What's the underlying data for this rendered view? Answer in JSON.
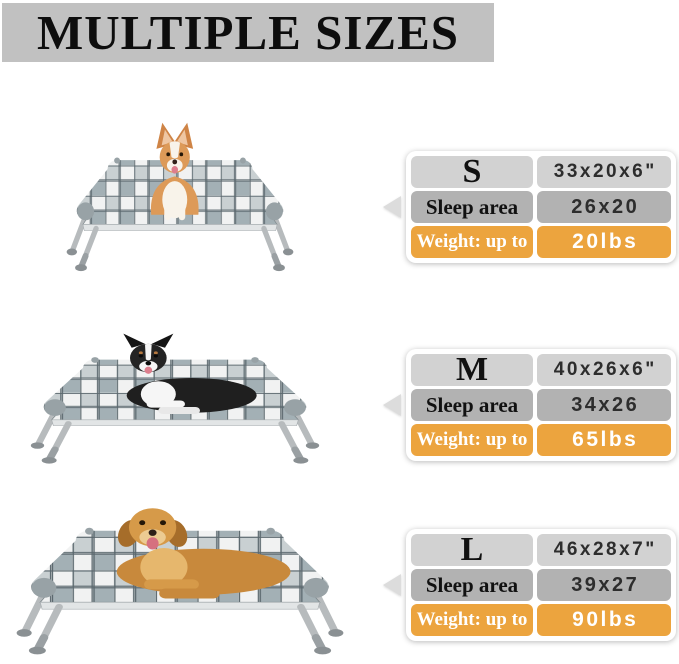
{
  "title": "MULTIPLE SIZES",
  "colors": {
    "title_bar_bg": "#c1c1c1",
    "spec_top_row_bg": "#d2d2d2",
    "spec_mid_row_bg": "#b2b2b2",
    "weight_row_bg": "#eca43e",
    "value_text": "#2d2d2d",
    "weight_text": "#ffffff"
  },
  "sizes": [
    {
      "label": "S",
      "dimensions": "33x20x6\"",
      "sleep_area_label": "Sleep area",
      "sleep_area_value": "26x20",
      "weight_label": "Weight: up to",
      "weight_value": "20lbs",
      "photo_alt": "Corgi sitting on small elevated plaid dog bed"
    },
    {
      "label": "M",
      "dimensions": "40x26x6\"",
      "sleep_area_label": "Sleep area",
      "sleep_area_value": "34x26",
      "weight_label": "Weight: up to",
      "weight_value": "65lbs",
      "photo_alt": "Australian Shepherd lying on medium elevated plaid dog bed"
    },
    {
      "label": "L",
      "dimensions": "46x28x7\"",
      "sleep_area_label": "Sleep area",
      "sleep_area_value": "39x27",
      "weight_label": "Weight: up to",
      "weight_value": "90lbs",
      "photo_alt": "Golden Retriever lying on large elevated plaid dog bed"
    }
  ]
}
